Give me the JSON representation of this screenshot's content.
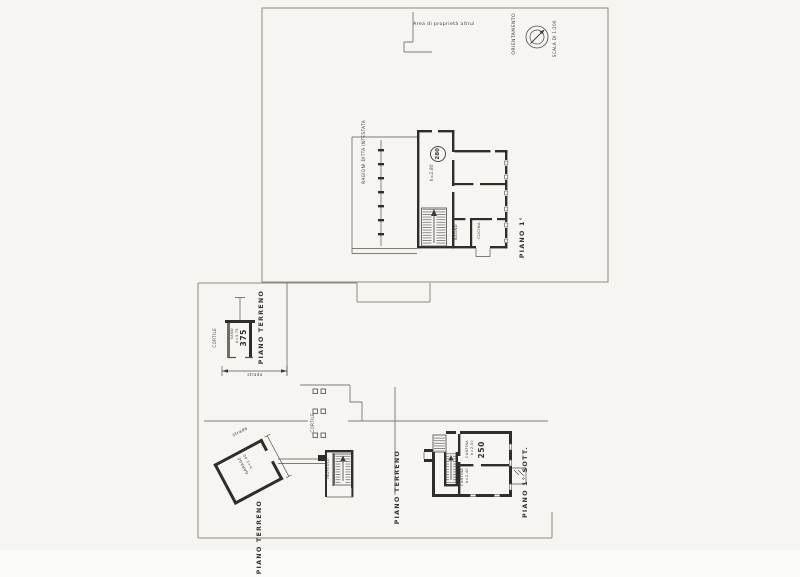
{
  "page": {
    "background": "#f6f5f1",
    "ink": "#2e2d29",
    "frame": "#8b8a84"
  },
  "upper_sheet": {
    "boundary_note": "Area di proprietà altrui",
    "compass": {
      "label": "ORIENTAMENTO",
      "scale": "SCALA DI 1:200"
    },
    "floor_label": "PIANO 1°",
    "owner_note": "RAGIONI DITTA INTESTATA",
    "main_room": {
      "number": "280",
      "height": "h=2.80"
    },
    "rooms": {
      "bagno": "BAGNO",
      "cucina": "CUCINA"
    }
  },
  "ground_floor": {
    "label_shed": "PIANO TERRENO",
    "label_courtyard": "PIANO TERRENO",
    "label_street": "PIANO TERRENO",
    "cortile_shed": "CORTILE",
    "cortile_main": "CORTILE",
    "shed": {
      "name": "VANO",
      "height": "h=3.75",
      "number": "375"
    },
    "dimension_note": "strada",
    "street_note": "strada",
    "ingresso": "INGRESSO",
    "garage": {
      "name": "GARAGE",
      "height": "h=2.40"
    }
  },
  "basement": {
    "label": "PIANO 1° SOTT.",
    "cantina_upper": {
      "name": "CANTINA",
      "height": "h=2.50",
      "number": "250"
    },
    "cantina_lower": {
      "name": "CANTINA",
      "height": "h=2.40"
    }
  }
}
